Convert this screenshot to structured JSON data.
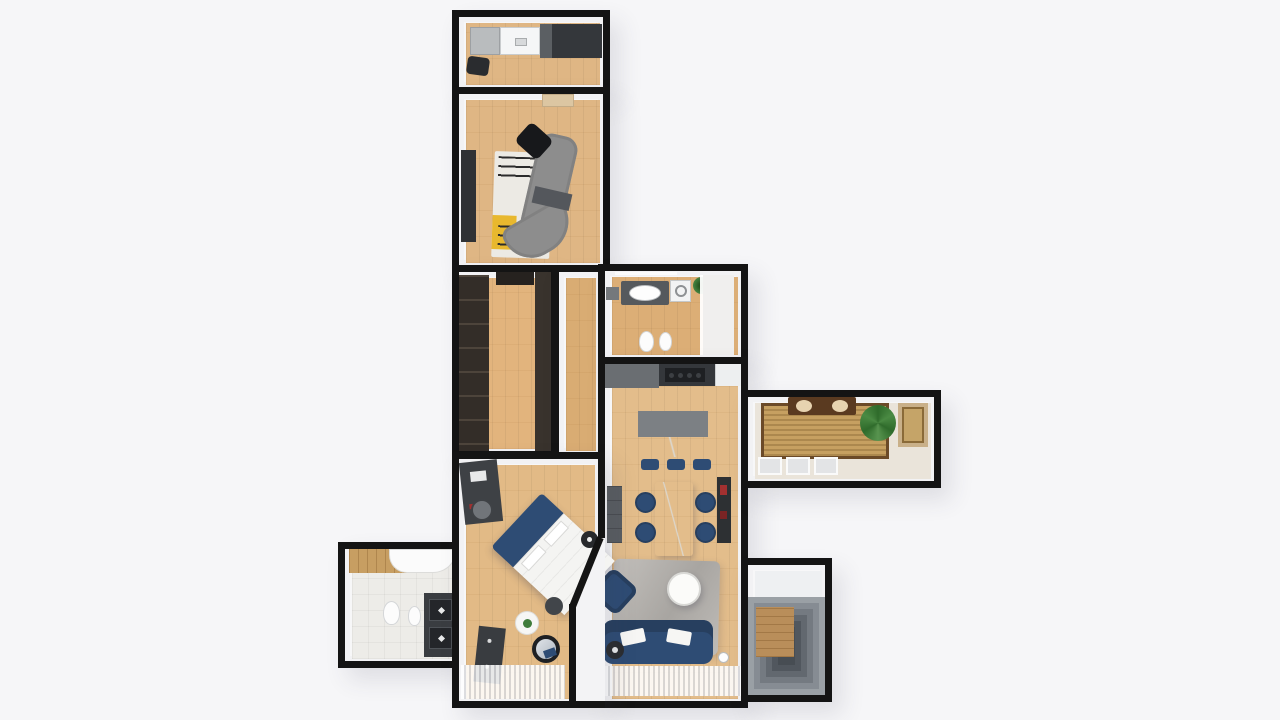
{
  "scene": {
    "title": "apartment-3d-floor-plan-top-view",
    "background": "#f6f6f8"
  },
  "palette": {
    "wall": "#141414",
    "wall-face": "#f3f3f5",
    "background": "#f6f6f8",
    "wood": "#dfb684",
    "wood-light": "#e6c296",
    "wood-dark": "#d6a76f",
    "navy": "#2e4c74",
    "navy-dark": "#273f5f",
    "gray-cabinet": "#55595d",
    "dark-cabinet": "#34373b",
    "sofa-gray": "#8d8d8d",
    "rug-white": "#eceae4",
    "rug-gray": "#b5b2ae",
    "marble": "#f4f3f0",
    "wicker": "#c6a061",
    "wicker-border": "#6b4a28",
    "plant": "#3f7c3b",
    "tile": "#edece8",
    "stair-dark": "#474d53",
    "stair-light": "#9aa0a5",
    "wood-wall": "#c79e62",
    "accent-yellow": "#e8b82e",
    "accent-red": "#a33030"
  },
  "rooms": [
    {
      "id": "kitchen-top",
      "label": "Small Kitchen",
      "furniture": [
        "fridge",
        "sink-counter",
        "dark-cabinets",
        "stool"
      ]
    },
    {
      "id": "media-lounge",
      "label": "Media Lounge",
      "furniture": [
        "door",
        "tv-panel",
        "area-rug",
        "curved-gray-sofa"
      ]
    },
    {
      "id": "walk-in-closet",
      "label": "Walk-in Closet",
      "furniture": [
        "shelving-unit",
        "wardrobe-panel"
      ]
    },
    {
      "id": "hallway",
      "label": "Hallway",
      "furniture": []
    },
    {
      "id": "bathroom-main",
      "label": "Bathroom",
      "furniture": [
        "towel-bar",
        "shelf",
        "vanity-sink",
        "washing-machine",
        "plant",
        "glass-partition",
        "shower",
        "toilet",
        "bidet"
      ]
    },
    {
      "id": "living-dining",
      "label": "Living / Dining / Kitchen",
      "furniture": [
        "kitchen-counter",
        "cooktop",
        "island",
        "bar-stools",
        "dining-table",
        "dining-chairs",
        "sideboard",
        "bookshelf",
        "shag-rug",
        "coffee-table",
        "armchair",
        "sofa",
        "side-table",
        "floor-lamp",
        "sheer-curtain"
      ]
    },
    {
      "id": "balcony",
      "label": "Balcony",
      "furniture": [
        "bench",
        "cushions",
        "wicker-rug",
        "potted-plant",
        "framed-window",
        "floor-windows"
      ]
    },
    {
      "id": "ensuite-bathroom",
      "label": "En-suite Bathroom",
      "furniture": [
        "wood-wall",
        "bathtub",
        "toilet",
        "bidet",
        "double-vanity"
      ]
    },
    {
      "id": "bedroom",
      "label": "Bedroom",
      "furniture": [
        "desk",
        "desk-chair",
        "bed",
        "nightstand",
        "pouf",
        "plant-stand",
        "round-mirror",
        "dresser",
        "sheer-curtain"
      ]
    },
    {
      "id": "staircase",
      "label": "Staircase",
      "furniture": [
        "landing",
        "stairs",
        "wood-panel"
      ]
    }
  ]
}
